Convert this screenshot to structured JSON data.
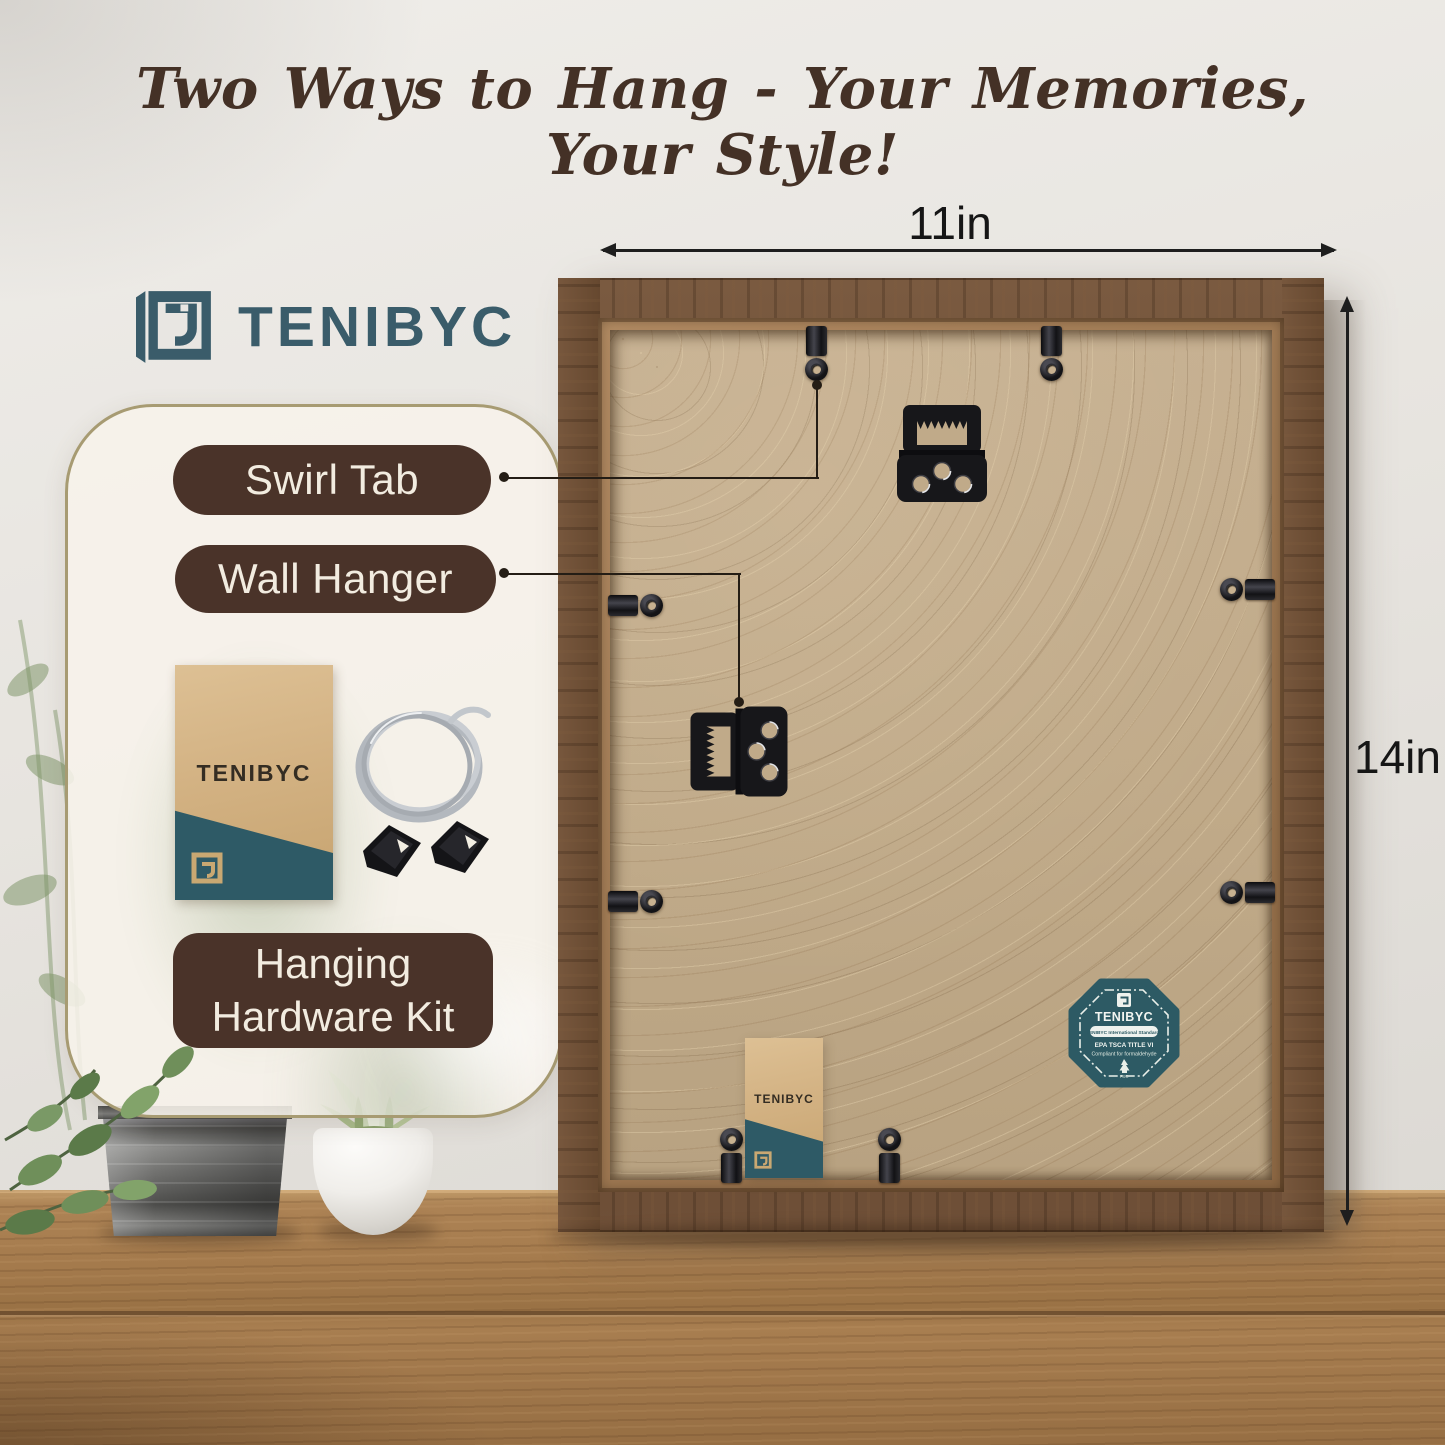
{
  "title": "Two Ways to Hang - Your Memories, Your Style!",
  "brand": {
    "name": "TENIBYC"
  },
  "callouts": {
    "swirl_tab": "Swirl Tab",
    "wall_hanger": "Wall Hanger",
    "hardware_kit": "Hanging Hardware Kit"
  },
  "dimensions": {
    "width": "11in",
    "height": "14in"
  },
  "kit_envelope": {
    "brand": "TENIBYC"
  },
  "frame_envelope": {
    "brand": "TENIBYC"
  },
  "badge": {
    "brand": "TENIBYC",
    "pill": "TENIBYC International Standards",
    "line1": "EPA TSCA TITLE VI",
    "line2": "Compliant for formaldehyde",
    "cert": "FSC"
  },
  "icons": {
    "logo": "tenibyc-frame-logo-icon",
    "sawtooth": "sawtooth-hanger-icon",
    "swirl_tab": "swirl-tab-icon",
    "wire": "hanging-wire-icon",
    "tree": "fsc-tree-icon"
  },
  "colors": {
    "brand_teal": "#3A5C6A",
    "badge_teal": "#2D5A64",
    "callout_brown": "#4A3329",
    "title_brown": "#443126",
    "frame_wood": "#6F5038",
    "board_tan": "#C2AC8B",
    "table_wood": "#A07A4E"
  }
}
